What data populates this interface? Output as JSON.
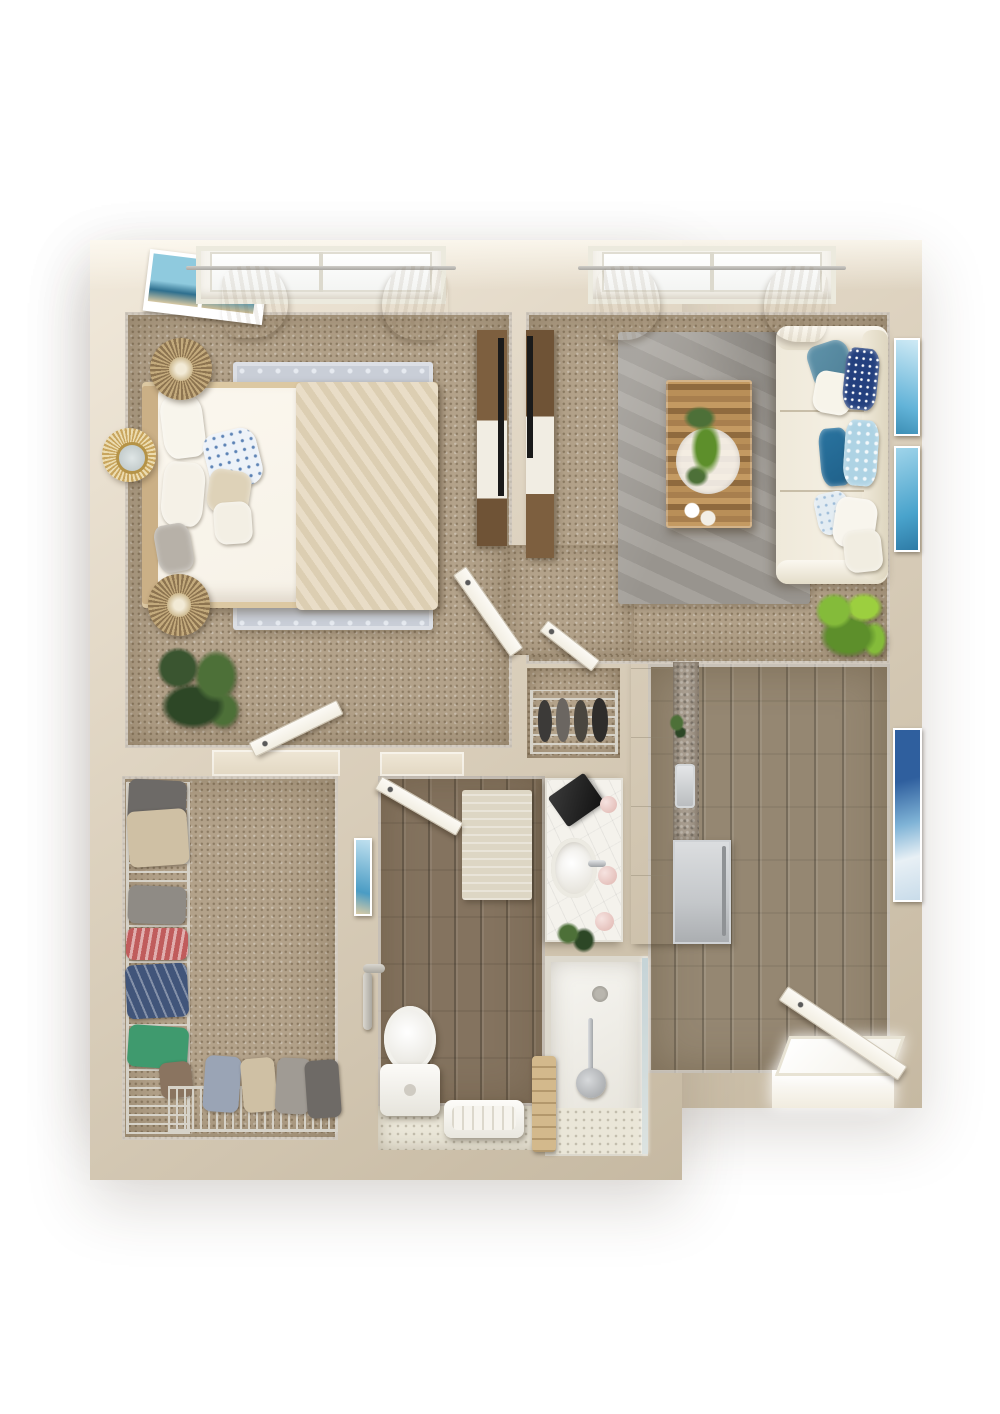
{
  "scene": {
    "type": "3d-floorplan-top-down-render",
    "visible_text": "none — photorealistic unlabeled floor plan",
    "layout": "one-bedroom apartment: bedroom top-left, living room top-right, walk-in closet bottom-left, bathroom bottom-center, entry hall with laundry/kitchenette bottom-right",
    "rooms": [
      {
        "id": "bedroom",
        "floor": "tan carpet",
        "contents": [
          "queen-bed with cream duvet and herringbone throw",
          "white and blue-floral pillows",
          "light gray quatrefoil area rug",
          "two rattan drum tables",
          "gold sunburst mirror",
          "two-panel seascape wall art",
          "window with ivory curtains",
          "potted pine plant",
          "media console with tv",
          "open closet door"
        ]
      },
      {
        "id": "living-room",
        "floor": "tan carpet",
        "contents": [
          "cream three-seat sofa",
          "throw pillows in teal navy and light blue",
          "gray mottled area rug",
          "wood plank coffee table with greenery and white tray",
          "window with ivory curtains",
          "two feather ocean art prints",
          "bright fiddle-leaf plant",
          "media console with tv"
        ]
      },
      {
        "id": "walk-in-closet",
        "floor": "tan carpet",
        "contents": [
          "wire shelving left wall with hanging clothes (gray, tan, red, navy, green, brown)",
          "wire shoe rack along bottom wall",
          "hanging denim and jackets",
          "shoes"
        ]
      },
      {
        "id": "hall",
        "floor": "tan carpet",
        "contents": [
          "open bedroom door",
          "small shoe closet with wire rack and shoes",
          "open closet door"
        ]
      },
      {
        "id": "bathroom",
        "floor": "gray-brown wood plank",
        "contents": [
          "open door",
          "beige bath mat",
          "white toilet with grab bar",
          "towel bench",
          "marble vanity with oval sink, black tray, pink bottles and plant",
          "walk-in shower with glass panel, drain, hand shower, tiled strip and towel ladder",
          "small blue wall art"
        ]
      },
      {
        "id": "entry",
        "floor": "gray wood plank",
        "contents": [
          "open front door with bright threshold",
          "tall white cabinet",
          "stone backsplash with small plant and chrome sink",
          "stacked laundry appliance",
          "tall blue abstract wall art"
        ]
      }
    ]
  },
  "palette": {
    "bg": "#ffffff",
    "wall": "#ddd2bf",
    "wallHi": "#f1e9db",
    "wallLo": "#c6b9a2",
    "carpet": "#b3a28a",
    "carpetDot": "#8d7c64",
    "woodB": "#84735f",
    "entryA": "#958772",
    "tile": "#eae6d8",
    "stone": "#a89d8f",
    "wire": "#d6d2c8",
    "rugBed": "#c9ced7",
    "rugBedDot": "#e6eaf0",
    "rugLiv": "#a19d97",
    "linen": "#f6f1e7",
    "throwA": "#e9ddc7",
    "throwB": "#dcceb2",
    "frameWood": "#dcc8a2",
    "headboard": "#cbb086",
    "sofa": "#f4efe2",
    "teal": "#4e7f96",
    "navy": "#24407e",
    "dkblue": "#1f6089",
    "ltblue": "#aed3e4",
    "rattan1": "#c3aa7c",
    "rattan2": "#8d7450",
    "gold": "#c8a55e",
    "plantDk": "#3a5530",
    "plantMd": "#4d7038",
    "plantBr": "#84bb3a",
    "marble": "#f4f2ec",
    "chrome": "#c6c9cc",
    "appliance": "#c4c7ca",
    "tv": "#1a1a1a",
    "furnWood": "#7d5f3f",
    "whiteFurn": "#fafaf7",
    "artTeal": "#3d8fb5",
    "artBlue": "#2f5f9e",
    "towel": "#d3b98c",
    "doorWhite": "#f2eee2",
    "mat": "#ddd6c4",
    "red": "#c05c5c",
    "green": "#3f9a6e",
    "denim": "#9aa4b5",
    "tan": "#cfc0a4",
    "gray": "#8f8b85",
    "darkcloth": "#6d6a67",
    "navycloth": "#41557a",
    "brown": "#8a7460"
  }
}
